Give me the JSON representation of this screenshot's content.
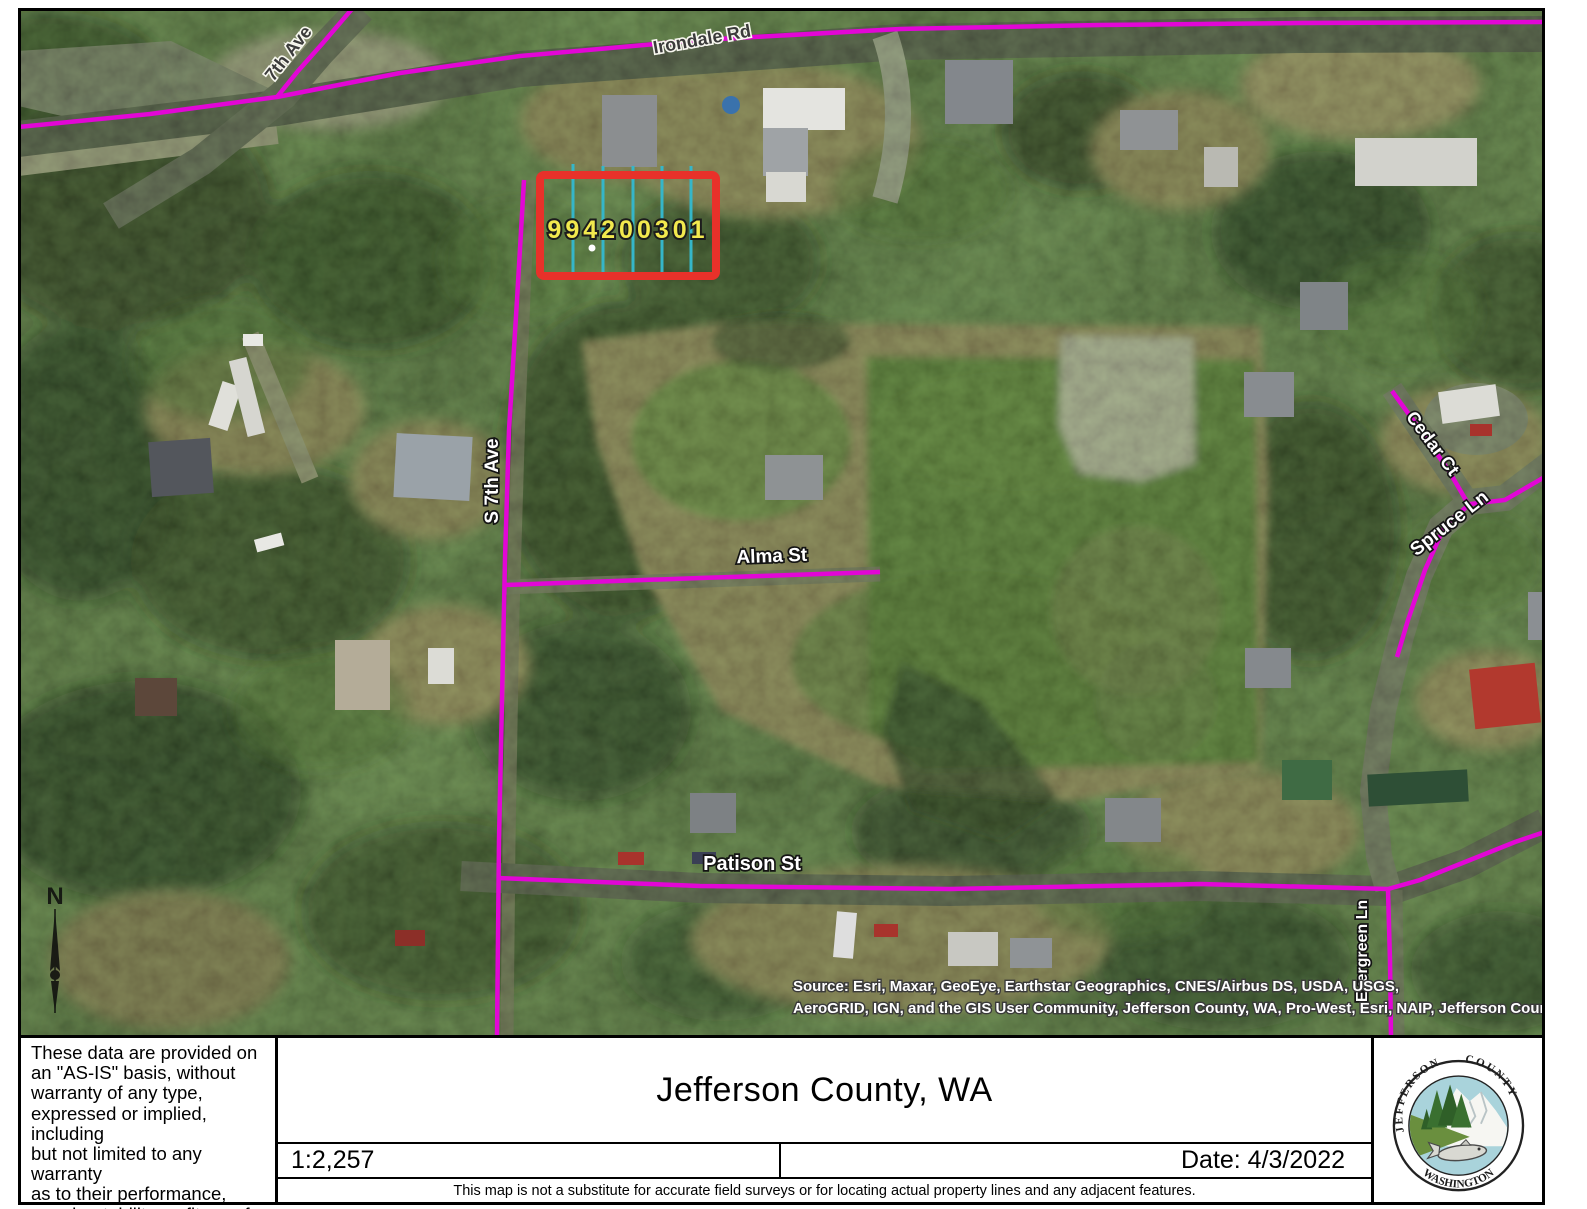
{
  "map": {
    "parcel": {
      "id": "994200301"
    },
    "streets": {
      "seventh_ave": "7th Ave",
      "irondale_rd": "Irondale Rd",
      "s_seventh_ave": "S 7th Ave",
      "alma_st": "Alma St",
      "patison_st": "Patison St",
      "cedar_ct": "Cedar Ct",
      "spruce_ln": "Spruce Ln",
      "evergreen_ln": "Evergreen Ln"
    },
    "north_label": "N",
    "attribution": {
      "line1": "Source: Esri, Maxar, GeoEye, Earthstar Geographics, CNES/Airbus DS, USDA, USGS,",
      "line2": "AeroGRID, IGN, and the GIS User Community, Jefferson County, WA, Pro-West, Esri, NAIP, Jefferson County"
    },
    "colors": {
      "road_centerline": "#e206d6",
      "parcel_highlight": "#e8312a",
      "lot_lines": "#35b6c9",
      "parcel_label_text": "#f2e94e"
    }
  },
  "panel": {
    "disclaimer_lines": [
      "These data are provided on",
      "an \"AS-IS\" basis, without",
      "warranty of any type,",
      "expressed or implied, including",
      "but not limited to any warranty",
      "as to their performance,",
      "merchantability, or fitness for",
      "any particular purpose."
    ],
    "title": "Jefferson County, WA",
    "scale": "1:2,257",
    "date": "Date: 4/3/2022",
    "note": "This map is not a substitute for accurate field surveys or for locating actual property lines and any adjacent features."
  },
  "logo": {
    "arc_top_left": "JEFFERSON",
    "arc_top_right": "COUNTY",
    "arc_bottom": "WASHINGTON"
  }
}
